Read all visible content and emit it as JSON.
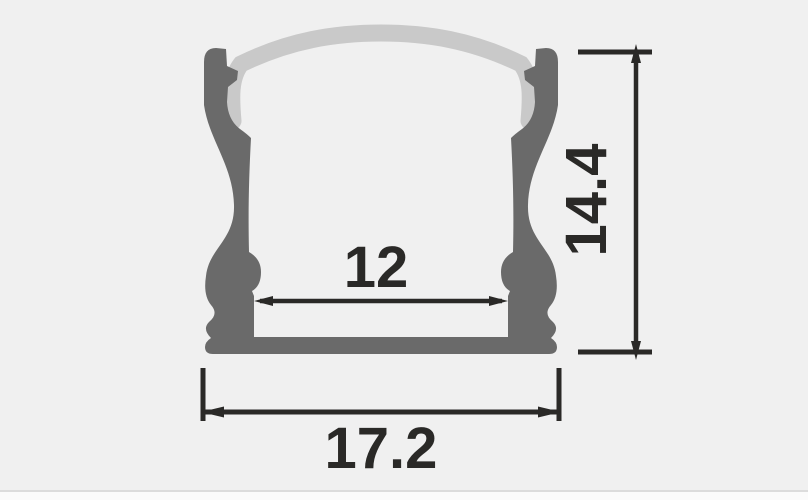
{
  "diagram": {
    "type": "technical-drawing",
    "view": "profile-cross-section",
    "dimensions": {
      "inner_width": {
        "label": "12"
      },
      "height": {
        "label": "14.4"
      },
      "outer_width": {
        "label": "17.2"
      }
    },
    "colors": {
      "background": "#f0f0f0",
      "profile_body": "#6a6a6a",
      "diffuser_cover": "#c9c9c9",
      "dimension_ink": "#2a2927",
      "footer_divider": "#dcdcdc",
      "footer_strip": "#fbfbfb"
    }
  }
}
